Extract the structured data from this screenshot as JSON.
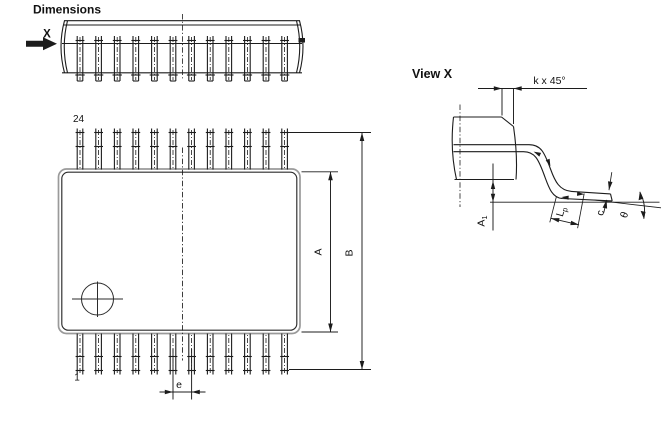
{
  "drawing": {
    "title": "Dimensions",
    "view_arrow_label": "X",
    "plan_view": {
      "pin_last_label": "24",
      "pin_first_label": "1",
      "dim_body_width": "A",
      "dim_overall_width": "B",
      "dim_pitch": "e"
    },
    "detail_view": {
      "title": "View X",
      "dim_chamfer": "k x 45°",
      "dim_standoff_main": "A",
      "dim_standoff_sub": "1",
      "dim_foot_length_main": "L",
      "dim_foot_length_sub": "p",
      "dim_lead_thickness": "c",
      "dim_foot_angle": "θ"
    },
    "package": {
      "pins_per_side": 12,
      "pins_total": 24
    }
  },
  "colors": {
    "ink": "#1c1c1c",
    "body_outline": "#9a9a9a",
    "background": "#ffffff"
  }
}
